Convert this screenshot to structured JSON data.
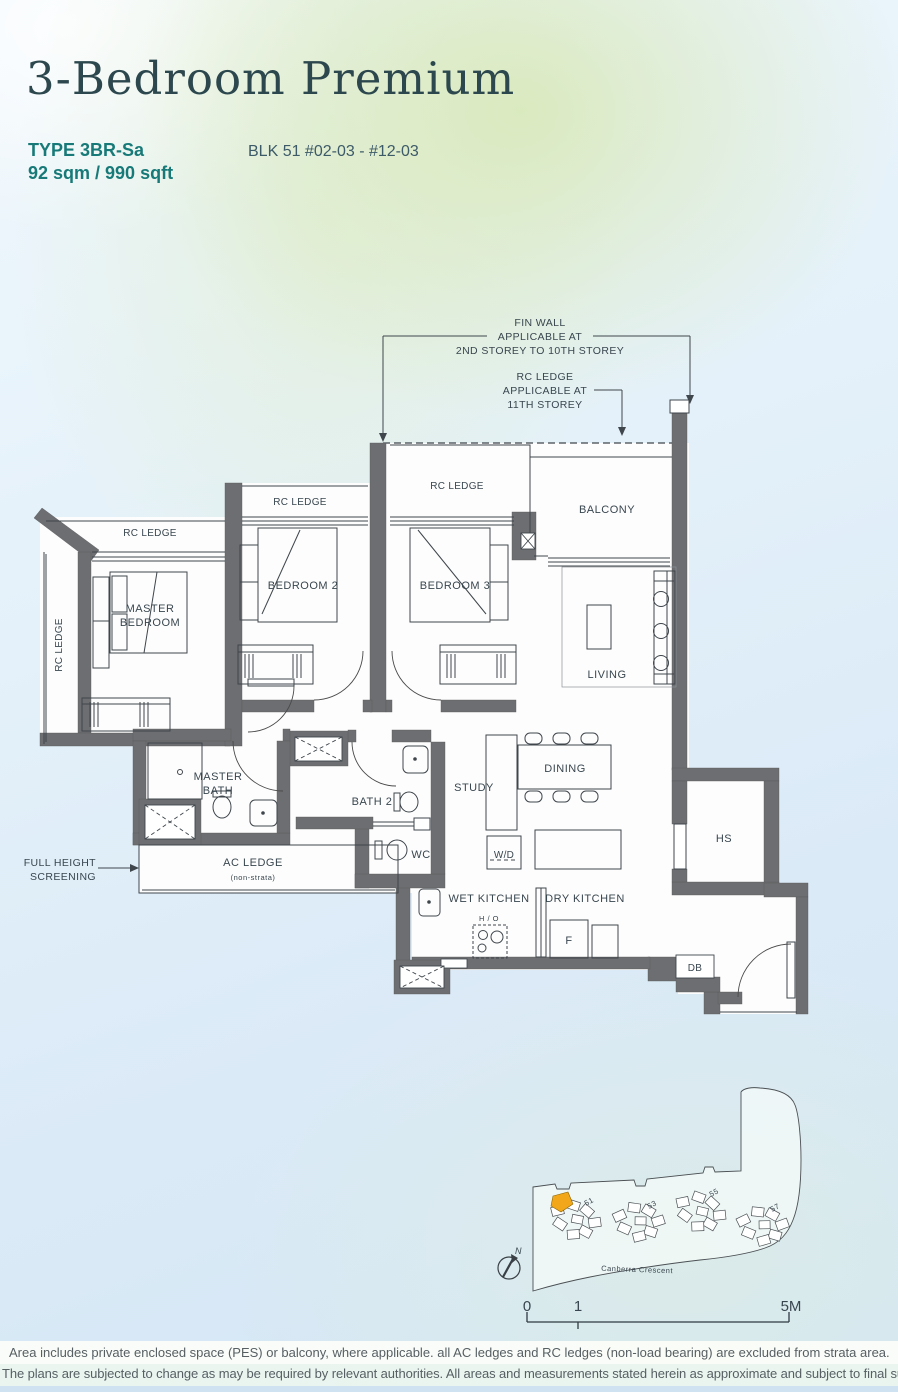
{
  "header": {
    "title": "3-Bedroom Premium",
    "type_label": "TYPE 3BR-Sa",
    "area_label": "92 sqm / 990 sqft",
    "block_label": "BLK 51 #02-03 - #12-03"
  },
  "annotations": {
    "fin_wall_1": "FIN WALL",
    "fin_wall_2": "APPLICABLE AT",
    "fin_wall_3": "2ND STOREY TO 10TH STOREY",
    "rc_note_1": "RC LEDGE",
    "rc_note_2": "APPLICABLE AT",
    "rc_note_3": "11TH STOREY",
    "fhs_1": "FULL HEIGHT",
    "fhs_2": "SCREENING"
  },
  "rooms": {
    "rc_ledge": "RC LEDGE",
    "master_1": "MASTER",
    "master_2": "BEDROOM",
    "bedroom2": "BEDROOM 2",
    "bedroom3": "BEDROOM 3",
    "balcony": "BALCONY",
    "living": "LIVING",
    "dining": "DINING",
    "study": "STUDY",
    "master_bath_1": "MASTER",
    "master_bath_2": "BATH",
    "bath2": "BATH 2",
    "wc": "WC",
    "wd": "W/D",
    "ac_ledge": "AC LEDGE",
    "ac_ledge_sub": "(non-strata)",
    "wet_kitchen": "WET KITCHEN",
    "dry_kitchen": "DRY KITCHEN",
    "hob": "H / O",
    "fridge": "F",
    "db": "DB",
    "hs": "HS"
  },
  "site_plan": {
    "blocks": [
      "51",
      "53",
      "55",
      "57"
    ],
    "street": "Canberra Crescent",
    "north_label": "N",
    "scale_0": "0",
    "scale_1": "1",
    "scale_5m": "5M",
    "highlight_color": "#f2a71b"
  },
  "footer": {
    "line1": "Area includes private enclosed space (PES) or balcony, where applicable. all AC ledges and RC ledges (non-load bearing) are excluded from strata area.",
    "line2": "The plans are subjected to change as may be required by relevant authorities. All areas and measurements stated herein as approximate and subject to final survey."
  },
  "colors": {
    "wall": "#6d6e71",
    "accent_teal": "#177a78",
    "title": "#2c474d",
    "highlight": "#f2a71b"
  }
}
